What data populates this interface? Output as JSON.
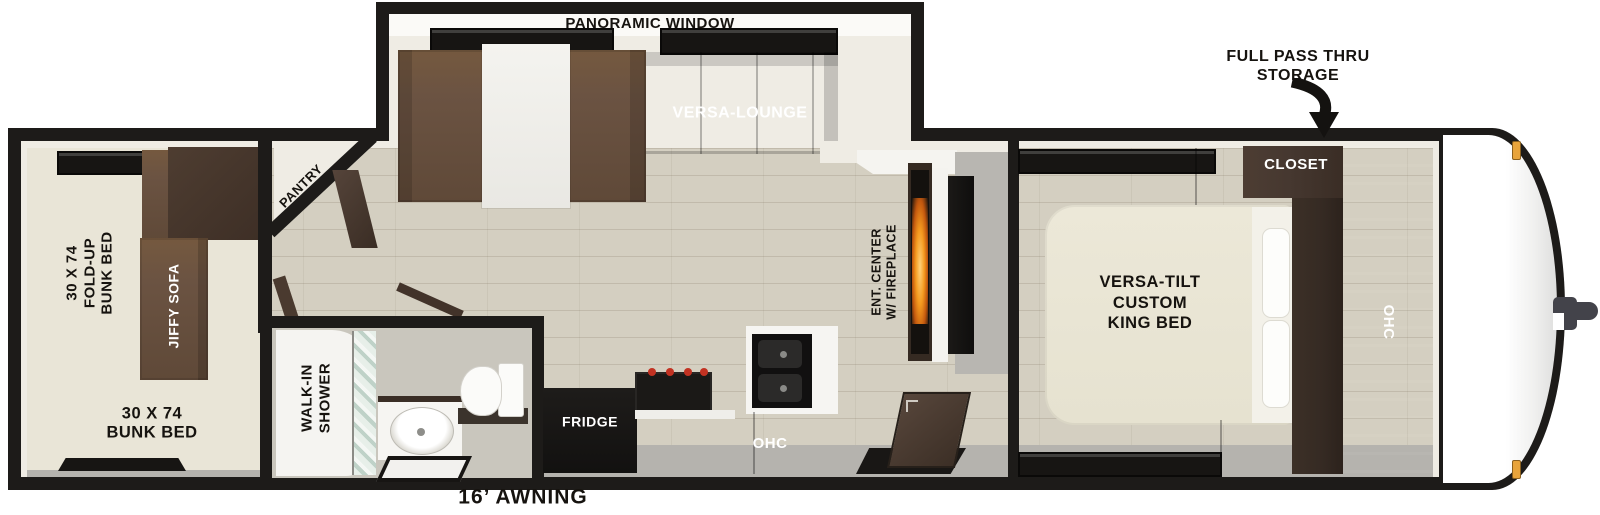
{
  "diagram": {
    "type": "rv-travel-trailer-floorplan",
    "annotations": {
      "panoramic_window": "PANORAMIC WINDOW",
      "full_pass_thru": [
        "FULL PASS THRU",
        "STORAGE"
      ],
      "awning": "16’ AWNING"
    },
    "rooms": {
      "bunkhouse": {
        "fold_up_bunk": [
          "30 X 74",
          "FOLD-UP",
          "BUNK BED"
        ],
        "jiffy_sofa": "JIFFY SOFA",
        "bunk_bed": [
          "30 X 74",
          "BUNK BED"
        ]
      },
      "main": {
        "versa_lounge": "VERSA-LOUNGE",
        "pantry": "PANTRY",
        "fridge": "FRIDGE",
        "ohc": "OHC",
        "ent_center": [
          "ENT. CENTER",
          "W/ FIREPLACE"
        ]
      },
      "bathroom": {
        "walk_in_shower": [
          "WALK-IN",
          "SHOWER"
        ]
      },
      "bedroom": {
        "king_bed": [
          "VERSA-TILT",
          "CUSTOM",
          "KING BED"
        ],
        "closet": "CLOSET",
        "ohc": "OHC"
      }
    },
    "palette": {
      "wall": "#1d1b19",
      "floor_wood": "#d4cfc1",
      "interior_trim": "#efece4",
      "sofa_brown": "#6b5342",
      "cabinet_brown": "#463830",
      "bed_cream": "#e9e5d4",
      "walkway_gray": "#b5b3ae",
      "appliance_black": "#161412",
      "flame_orange": "#f59a1f",
      "marker_light_amber": "#e8a43c"
    }
  }
}
